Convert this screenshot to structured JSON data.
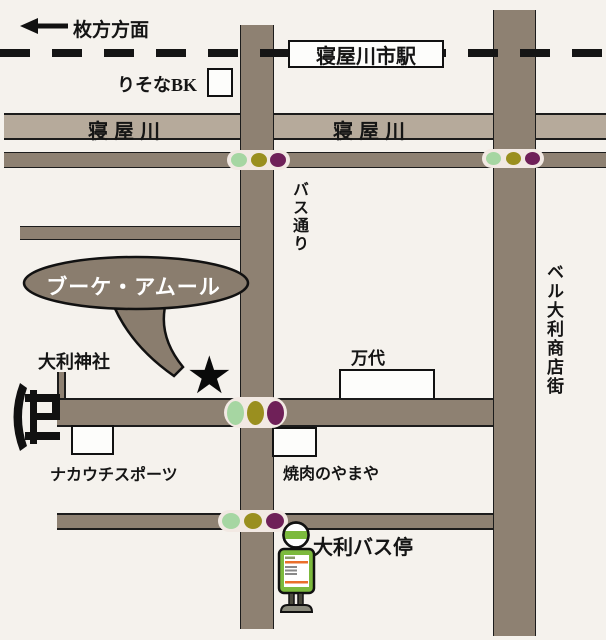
{
  "labels": {
    "direction": "枚方方面",
    "station": "寝屋川市駅",
    "bank": "りそなBK",
    "river_left": "寝屋川",
    "river_right": "寝屋川",
    "bus_street": "バス通り",
    "shop": "ブーケ・アムール",
    "shrine": "大利神社",
    "supermarket": "万代",
    "sports_store": "ナカウチスポーツ",
    "restaurant": "焼肉のやまや",
    "bus_stop": "大利バス停",
    "shopping_street": "ベル大利商店街",
    "star": "★"
  },
  "colors": {
    "background": "#f5f2ed",
    "road": "#8e8172",
    "river": "#b6aa9b",
    "bubble": "#8a7d6e",
    "outline": "#1c1c1c",
    "signal_capsule": "#f2e9e3",
    "signal_green": "#a6d6a2",
    "signal_yellow": "#9a8f1f",
    "signal_purple": "#6f2058",
    "bus_sign_green": "#7cba3d",
    "timetable_orange": "#e96f2b",
    "base_gray": "#8b8b7d"
  },
  "icons": {
    "direction_arrow": "left-arrow-icon",
    "railway": "railway-dashed-line",
    "torii": "torii-gate-icon",
    "star_marker": "star-icon",
    "traffic_signals": "traffic-light-icon",
    "bus_stop_sign": "bus-stop-sign-icon"
  }
}
